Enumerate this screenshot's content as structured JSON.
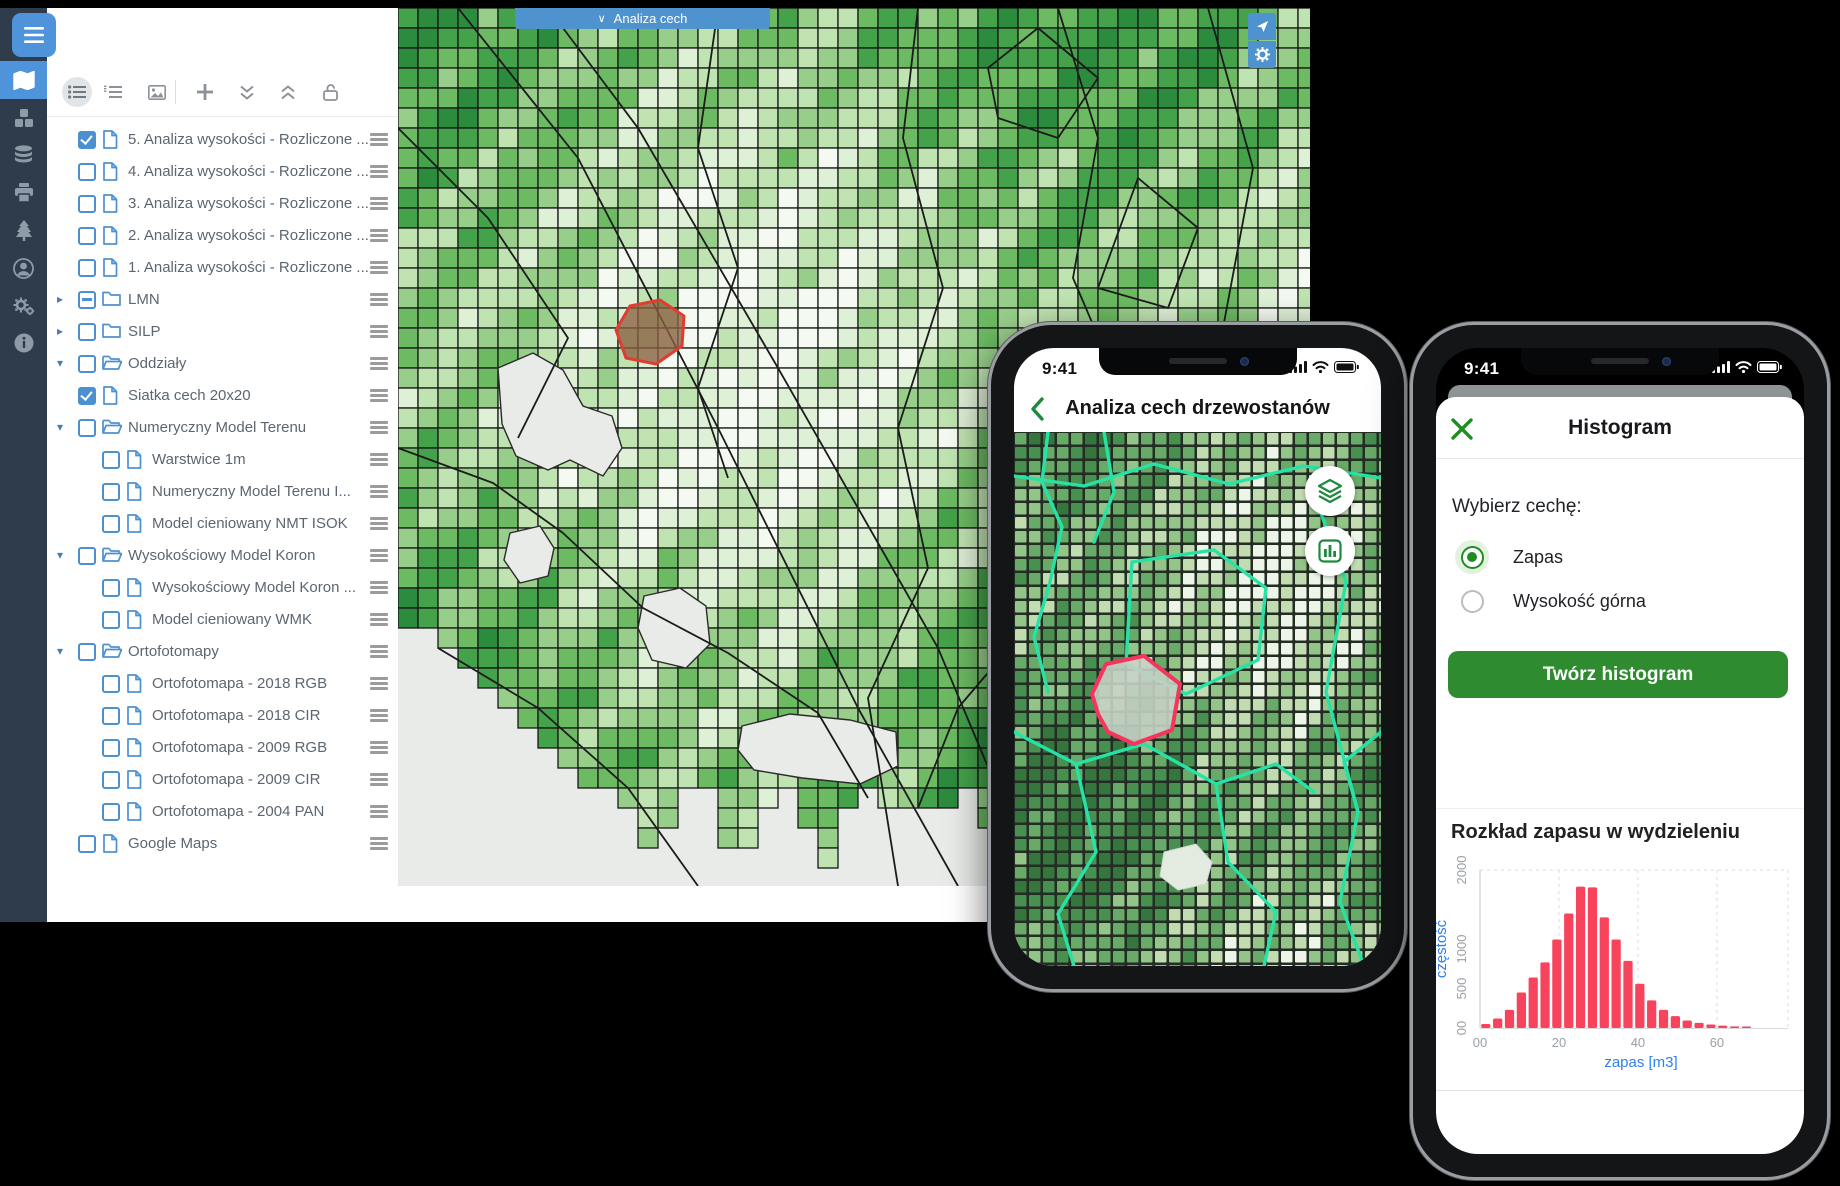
{
  "desktop": {
    "sidebar": {
      "menu_icon": "hamburger-icon",
      "icons": [
        "map",
        "modules",
        "database",
        "printer",
        "forest",
        "user",
        "settings",
        "info"
      ],
      "active_icon": "map"
    },
    "toolbar": {
      "icons": [
        "layer-list",
        "ordered-list",
        "basemap-image",
        "add-layer",
        "collapse-all",
        "expand-all",
        "unlock"
      ],
      "active_icon": "layer-list"
    },
    "layer_tree": [
      {
        "label": "5. Analiza wysokości - Rozliczone ...",
        "type": "file",
        "state": "checked",
        "indent": 0,
        "expander": "none"
      },
      {
        "label": "4. Analiza wysokości - Rozliczone ...",
        "type": "file",
        "state": "unchecked",
        "indent": 0,
        "expander": "none"
      },
      {
        "label": "3. Analiza wysokości - Rozliczone ...",
        "type": "file",
        "state": "unchecked",
        "indent": 0,
        "expander": "none"
      },
      {
        "label": "2. Analiza wysokości - Rozliczone ...",
        "type": "file",
        "state": "unchecked",
        "indent": 0,
        "expander": "none"
      },
      {
        "label": "1. Analiza wysokości - Rozliczone ...",
        "type": "file",
        "state": "unchecked",
        "indent": 0,
        "expander": "none"
      },
      {
        "label": "LMN",
        "type": "folder-closed",
        "state": "indeterminate",
        "indent": 0,
        "expander": "collapsed"
      },
      {
        "label": "SILP",
        "type": "folder-closed",
        "state": "unchecked",
        "indent": 0,
        "expander": "collapsed"
      },
      {
        "label": "Oddziały",
        "type": "folder-open",
        "state": "unchecked",
        "indent": 0,
        "expander": "expanded"
      },
      {
        "label": "Siatka cech 20x20",
        "type": "file",
        "state": "checked",
        "indent": 0,
        "expander": "none"
      },
      {
        "label": "Numeryczny Model Terenu",
        "type": "folder-open",
        "state": "unchecked",
        "indent": 0,
        "expander": "expanded"
      },
      {
        "label": "Warstwice 1m",
        "type": "file",
        "state": "unchecked",
        "indent": 1,
        "expander": "none"
      },
      {
        "label": "Numeryczny Model Terenu I...",
        "type": "file",
        "state": "unchecked",
        "indent": 1,
        "expander": "none"
      },
      {
        "label": "Model cieniowany NMT ISOK",
        "type": "file",
        "state": "unchecked",
        "indent": 1,
        "expander": "none"
      },
      {
        "label": "Wysokościowy Model Koron",
        "type": "folder-open",
        "state": "unchecked",
        "indent": 0,
        "expander": "expanded"
      },
      {
        "label": "Wysokościowy Model Koron ...",
        "type": "file",
        "state": "unchecked",
        "indent": 1,
        "expander": "none"
      },
      {
        "label": "Model cieniowany WMK",
        "type": "file",
        "state": "unchecked",
        "indent": 1,
        "expander": "none"
      },
      {
        "label": "Ortofotomapy",
        "type": "folder-open",
        "state": "unchecked",
        "indent": 0,
        "expander": "expanded"
      },
      {
        "label": "Ortofotomapa - 2018 RGB",
        "type": "file",
        "state": "unchecked",
        "indent": 1,
        "expander": "none"
      },
      {
        "label": "Ortofotomapa - 2018 CIR",
        "type": "file",
        "state": "unchecked",
        "indent": 1,
        "expander": "none"
      },
      {
        "label": "Ortofotomapa - 2009 RGB",
        "type": "file",
        "state": "unchecked",
        "indent": 1,
        "expander": "none"
      },
      {
        "label": "Ortofotomapa - 2009 CIR",
        "type": "file",
        "state": "unchecked",
        "indent": 1,
        "expander": "none"
      },
      {
        "label": "Ortofotomapa - 2004 PAN",
        "type": "file",
        "state": "unchecked",
        "indent": 1,
        "expander": "none"
      },
      {
        "label": "Google Maps",
        "type": "file",
        "state": "unchecked",
        "indent": 0,
        "expander": "none"
      }
    ],
    "map": {
      "dropdown_label": "Analiza cech",
      "buttons": [
        "locate",
        "settings"
      ]
    }
  },
  "phone1": {
    "status_time": "9:41",
    "title": "Analiza cech drzewostanów",
    "back_icon": "chevron-left",
    "map_buttons": [
      "layers",
      "chart"
    ]
  },
  "phone2": {
    "status_time": "9:41",
    "sheet_title": "Histogram",
    "close_icon": "x",
    "choose_label": "Wybierz cechę:",
    "radios": [
      {
        "label": "Zapas",
        "selected": true
      },
      {
        "label": "Wysokość górna",
        "selected": false
      }
    ],
    "button_label": "Twórz histogram"
  },
  "chart_data": {
    "type": "bar",
    "title": "Rozkład zapasu w wydzieleniu",
    "xlabel": "zapas [m3]",
    "ylabel": "częstość",
    "bin_start": 0,
    "bin_width": 3,
    "values": [
      50,
      120,
      230,
      450,
      640,
      830,
      1120,
      1450,
      1790,
      1780,
      1400,
      1120,
      850,
      560,
      350,
      230,
      150,
      95,
      65,
      45,
      30,
      20,
      12
    ],
    "x_ticks": [
      {
        "label": "00",
        "value": 0
      },
      {
        "label": "20",
        "value": 20
      },
      {
        "label": "40",
        "value": 40
      },
      {
        "label": "60",
        "value": 60
      }
    ],
    "y_ticks": [
      {
        "label": "00",
        "value": 0
      },
      {
        "label": "500",
        "value": 500
      },
      {
        "label": "1000",
        "value": 1000
      },
      {
        "label": "2000",
        "value": 2000
      }
    ],
    "xlim": [
      0,
      78
    ],
    "ylim": [
      0,
      2000
    ],
    "grid": "dashed",
    "legend": "none",
    "bar_color": "#f8435c",
    "axis_label_color": "#2f80ed",
    "tick_color": "#9aa0a5"
  },
  "colors": {
    "accent_blue": "#4f94da",
    "map_bar_blue": "#4f93ce",
    "tree_blue": "#4d90d0",
    "sidebar_bg": "#2e3c4c",
    "green": "#2e8b2f",
    "radio_green": "#1e8e22",
    "teal_line": "#27e2a4",
    "bar_red": "#f8435c",
    "label_blue": "#2f80ed"
  },
  "maps": {
    "desktop": {
      "cell": 20,
      "cols": 46,
      "rows": 44,
      "seed": 7,
      "palette": [
        "#f4faf1",
        "#def0d6",
        "#bfe3b1",
        "#97cf8a",
        "#6cba62",
        "#44a24a",
        "#2c8c3e"
      ],
      "bg": "#e9ebe9",
      "grid_line": "#161616",
      "lakes": [
        "100,360 135,345 165,362 185,398 214,408 224,440 205,468 172,452 150,462 118,448 104,416",
        "112,525 142,518 156,540 150,568 122,575 106,552",
        "246,588 282,580 308,598 312,636 288,660 254,652 240,620",
        "344,718 392,706 452,712 498,724 500,758 462,776 404,770 356,762 340,742"
      ],
      "boundaries": [
        "60,0 180,150 320,420 460,700 560,878",
        "150,0 240,120 380,360 540,640 640,878",
        "0,120 90,210 170,330 120,430",
        "320,0 300,140 340,260 300,380 330,470",
        "520,0 505,130 545,280 500,420 530,560 470,690 500,878",
        "660,0 700,130 675,270 735,410 700,550 760,700 720,878",
        "810,0 855,160 825,320 885,500 855,660 912,720",
        "912,330 810,410 735,510 645,600 560,700 520,800",
        "0,440 95,475 165,525 245,600 330,645 420,705 470,790",
        "40,640 140,700 230,780 300,878",
        "590,60 640,20 700,70 660,130 600,110 590,60",
        "740,170 800,220 770,300 700,280 740,170"
      ],
      "highlight_polygon": "218,322 232,298 262,292 286,308 284,338 258,356 228,350",
      "highlight_fill": "#8a6040",
      "highlight_stroke": "#e23b30"
    },
    "phone": {
      "cell": 14,
      "size": 11.5,
      "cols": 27,
      "rows": 39,
      "seed": 23,
      "palette": [
        "#ecf5e7",
        "#c2dcb2",
        "#93c488",
        "#68aa67",
        "#47904f",
        "#35763f"
      ],
      "bg": "#242d24",
      "teal_paths": [
        "34,0 28,50 48,95 36,150 20,205 34,260",
        "0,44 70,54 140,32 215,52 290,34 367,46",
        "300,62 332,150 312,260 344,380 326,470 350,534",
        "118,130 200,118 252,156 244,228 172,262 112,232 118,130",
        "0,300 62,332 130,312 202,352 262,332 300,360",
        "62,332 82,420 44,482 60,534",
        "202,352 214,430 262,480 250,534",
        "90,0 100,60 80,110",
        "367,300 330,330 344,380"
      ],
      "red_polygon": "78,262 92,232 130,224 166,252 158,298 120,312 94,300 84,282",
      "red_fill": "#c6d1c5",
      "red_stroke": "#f4365f",
      "blob": "150,420 182,412 198,430 192,452 164,458 146,444"
    }
  }
}
